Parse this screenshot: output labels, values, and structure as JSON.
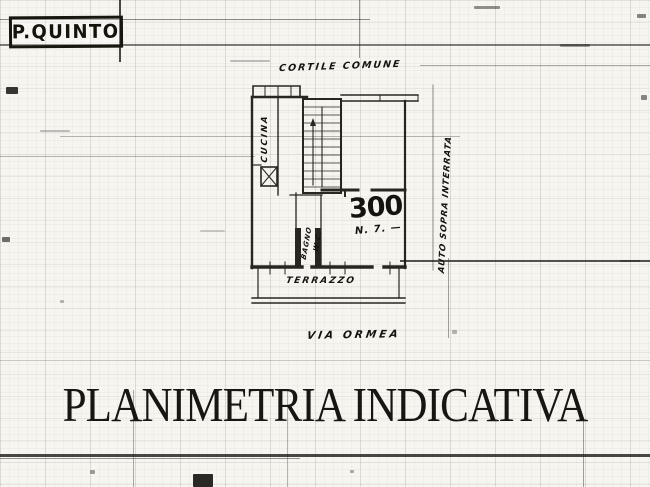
{
  "colors": {
    "paper": "#f7f5f0",
    "ink": "#1a1814"
  },
  "header": {
    "floor_label": "P.QUINTO"
  },
  "plan": {
    "courtyard_label": "CORTILE COMUNE",
    "kitchen_label": "CUCINA",
    "bath_label": "BAGNO",
    "wc_label": "W.C.",
    "room_number": "300",
    "room_note": "N. 7. —",
    "terrace_label": "TERRAZZO",
    "side_label": "AUTO SOPRA INTERRATA",
    "street_label": "VIA ORMEA"
  },
  "footer": {
    "title": "PLANIMETRIA INDICATIVA"
  }
}
